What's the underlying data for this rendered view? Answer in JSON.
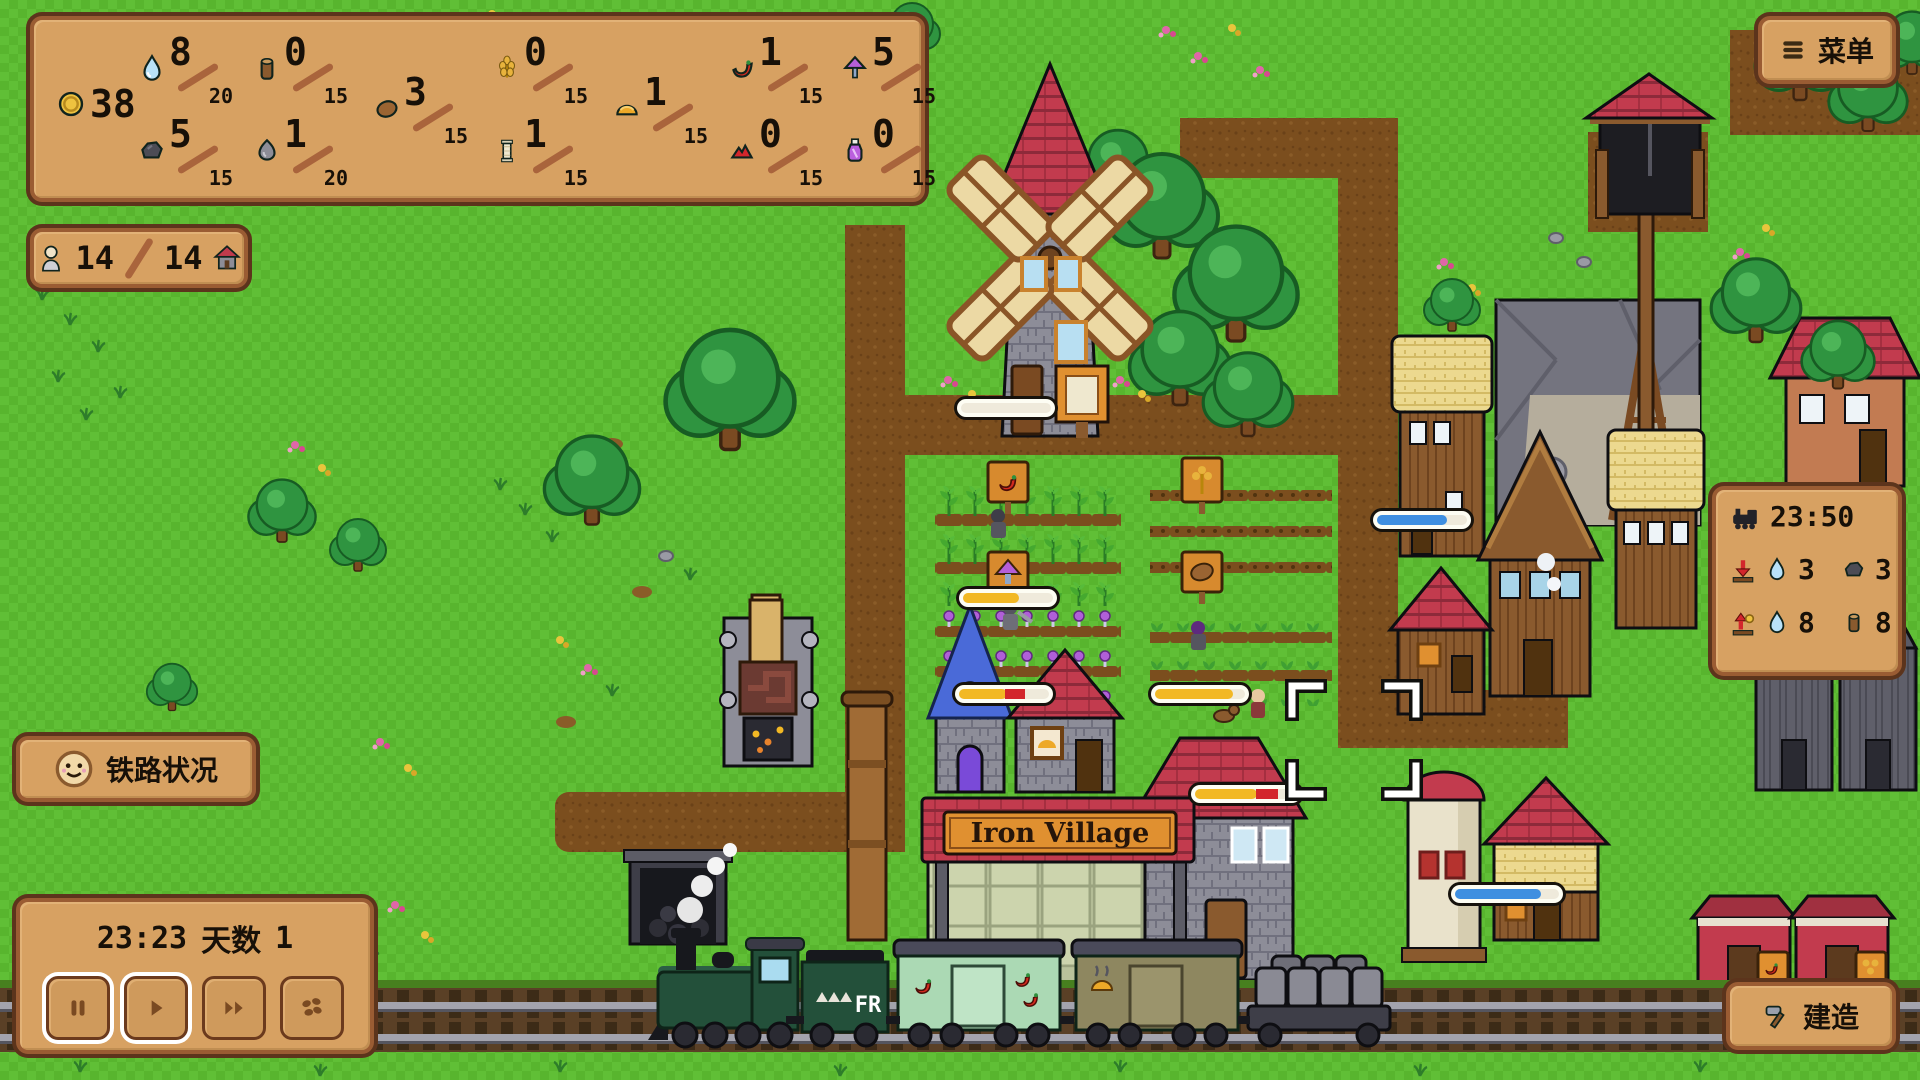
{
  "hud": {
    "coins": "38",
    "resources": [
      {
        "name": "water",
        "value": "8",
        "max": "20"
      },
      {
        "name": "log",
        "value": "0",
        "max": "15"
      },
      {
        "name": "wheat",
        "value": "0",
        "max": "15"
      },
      {
        "name": "chili",
        "value": "1",
        "max": "15"
      },
      {
        "name": "mushroom",
        "value": "5",
        "max": "15"
      },
      {
        "name": "coal",
        "value": "5",
        "max": "15"
      },
      {
        "name": "stone",
        "value": "1",
        "max": "20"
      },
      {
        "name": "potato",
        "value": "3",
        "max": "15"
      },
      {
        "name": "spool",
        "value": "1",
        "max": "15"
      },
      {
        "name": "bread",
        "value": "1",
        "max": "15"
      },
      {
        "name": "ruby",
        "value": "0",
        "max": "15"
      },
      {
        "name": "potion",
        "value": "0",
        "max": "15"
      }
    ],
    "population": {
      "current": "14",
      "max": "14"
    },
    "menu_button_label": "菜单",
    "railway_status_label": "铁路状况",
    "clock": {
      "time": "23:23",
      "day_label": "天数",
      "day_value": "1"
    },
    "train_schedule": {
      "time": "23:50",
      "unload": [
        {
          "resource": "water",
          "value": "3"
        },
        {
          "resource": "coal",
          "value": "3"
        }
      ],
      "load": [
        {
          "resource": "water",
          "value": "8"
        },
        {
          "resource": "log",
          "value": "8"
        }
      ]
    },
    "build_button_label": "建造"
  },
  "world": {
    "station_sign": "Iron Village",
    "tender_label": "FR"
  },
  "colors": {
    "panel": "#d7a162",
    "panel_border": "#9a5c33",
    "grass": "#58b52e",
    "path": "#7b4e1e",
    "roof_red": "#c23b4e",
    "bar_yellow": "#f2b824",
    "bar_blue": "#3f8fe0"
  }
}
